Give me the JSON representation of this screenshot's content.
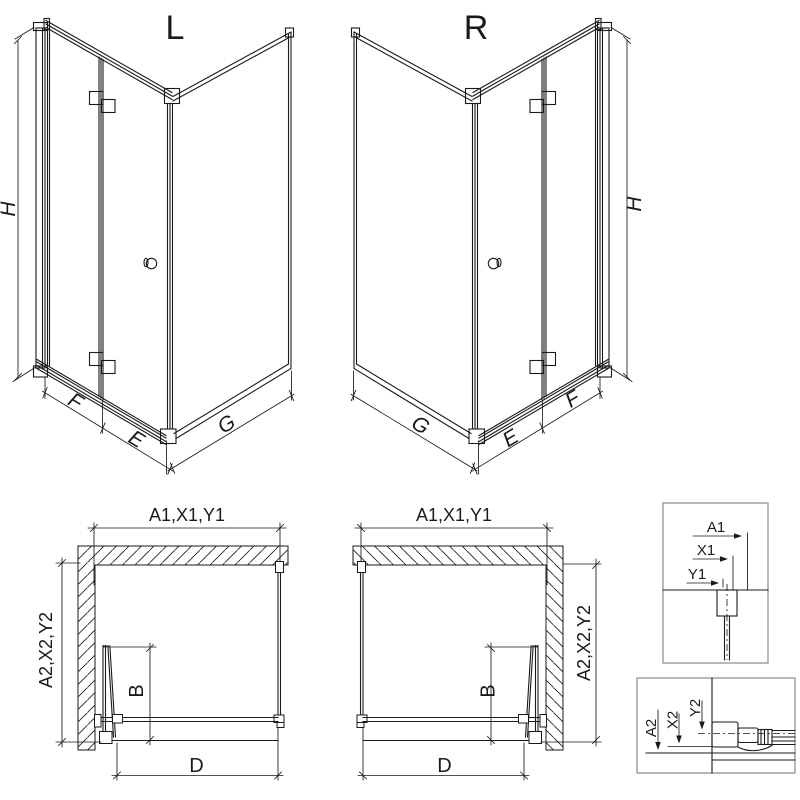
{
  "views": {
    "iso_left": {
      "label": "L"
    },
    "iso_right": {
      "label": "R"
    }
  },
  "dimensions": {
    "height": "H",
    "front_section_outer": "F",
    "front_section_inner": "E",
    "side_panel": "G",
    "width_combined": "A1,X1,Y1",
    "depth_combined": "A2,X2,Y2",
    "door_width": "B",
    "entry_width": "D"
  },
  "details": {
    "top": {
      "labels": [
        "A1",
        "X1",
        "Y1"
      ]
    },
    "bottom": {
      "labels": [
        "A2",
        "X2",
        "Y2"
      ]
    }
  },
  "colors": {
    "line": "#1a1a1a",
    "detail_border": "#8a8a8a",
    "background": "#ffffff"
  }
}
